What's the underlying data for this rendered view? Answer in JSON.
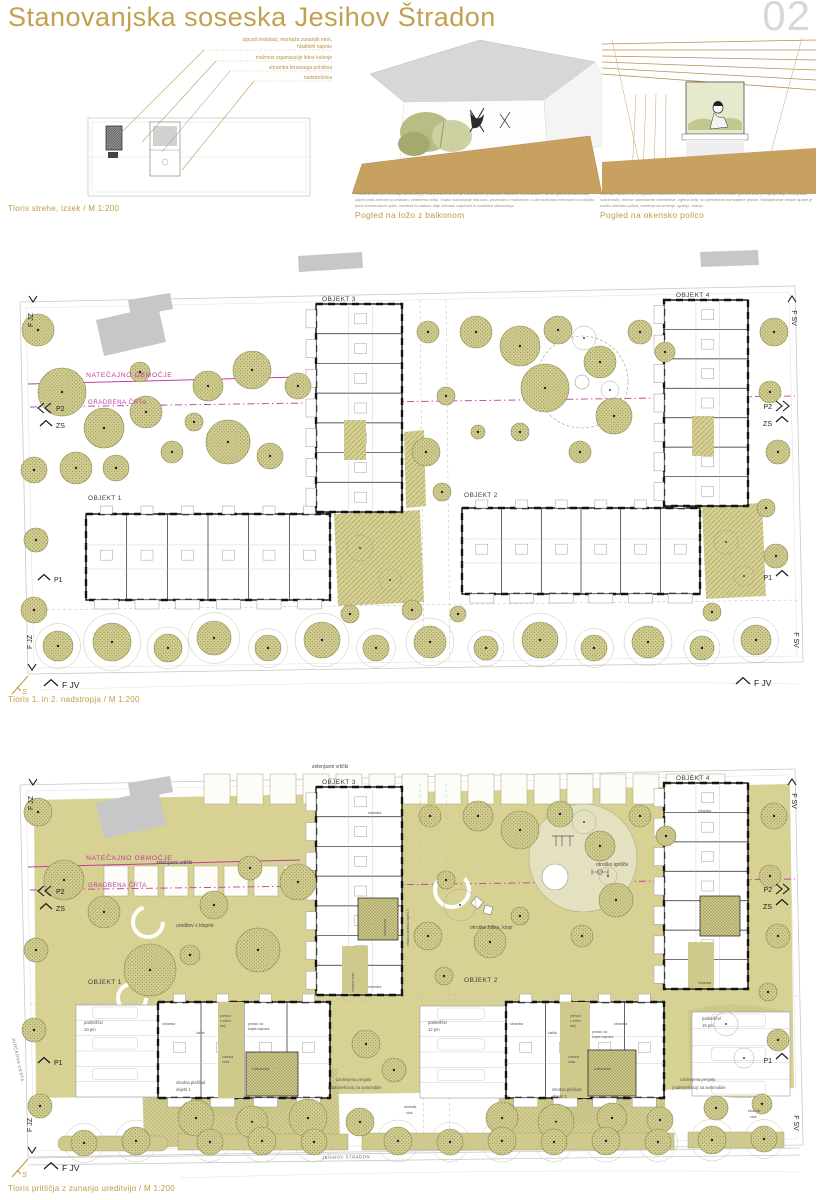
{
  "board": {
    "title": "Stanovanjska soseska Jesihov Štradon",
    "page_number": "02"
  },
  "roof_detail": {
    "caption": "Tloris strehe, izsek / M 1:200",
    "annotations": {
      "a1": "izpusti instalacij, montaža zunanjih enot,",
      "a1b": "hladilnih naprav",
      "a2": "možnost organizacije letne kuhinje",
      "a3": "shramba terasnega pohištva",
      "a4": "nadstrešnica"
    }
  },
  "perspectives": {
    "loggia": {
      "paragraph": "Posebna skrb pri snovanju stanovanj je bila posvečena že pri urbanistični postavitvi objektov s poudarkom, da se glavnina stanovanj odpre proti zelenim površinam, zelenemu atriju. Vsako stanovanje ima ložo, povezano z balkonom. Loža nudi tako intimnost kot zaščito pred vremenskimi vplivi, medtem ko balkon daje občutek odprtosti in razširitve stanovanja.",
      "heading": "Pogled na ložo z balkonom"
    },
    "window": {
      "paragraph": "Okenske špalete so poligonalno zasnovane, kar polici funkcionira kot sedišče (pomembno pri vgrajevanju energetske vzdržnosti), lesene nameščene zatemnitve, zgibna krila, so perforirane kompaktne plošče. Nadaljevanje širokih špalet je svetla okenska polica, namenjena sedenju, igranju, branju.",
      "heading": "Pogled na okensko polico"
    }
  },
  "plan_upper": {
    "caption": "Tloris 1. in 2. nadstropja / M 1:200",
    "labels": {
      "natecajno_obmocje": "NATEČAJNO OBMOČJE",
      "gradbena_crta": "GRADBENA ČRTA",
      "objekt_1": "OBJEKT 1",
      "objekt_2": "OBJEKT 2",
      "objekt_3": "OBJEKT 3",
      "objekt_4": "OBJEKT 4"
    }
  },
  "plan_ground": {
    "caption": "Tloris pritličja z zunanjo ureditvijo / M 1:200",
    "labels": {
      "natecajno_obmocje": "NATEČAJNO OBMOČJE",
      "gradbena_crta": "GRADBENA ČRTA",
      "objekt_1": "OBJEKT 1",
      "objekt_2": "OBJEKT 2",
      "objekt_3": "OBJEKT 3",
      "objekt_4": "OBJEKT 4",
      "zelenjavni_vrticki": "zelenjavni vrtički",
      "ureditev_s_klopmi": "ureditev s klopmi",
      "otrosko_igrisce": "otroško igrišče",
      "otroske_hiske_klopi": "otroške hiške, klopi",
      "parkirisce": "parkirišče/",
      "pm_10": "10 pm",
      "pm_12": "12 pm",
      "pm_15": "15 pm",
      "pergola_1": "ozelenjena pergola",
      "pergola_2": "(nadstrešnica) za avtomobile",
      "ekoloski_1": "ekološki",
      "ekoloski_2": "otok",
      "vhodna_ploscad": "vhodna ploščad",
      "objekt_1_ref": "objekt 1",
      "objekt_2_ref": "objekt 2",
      "vp_objekt_3": "vhodna ploščad objekt 3",
      "prehod_1": "prehod",
      "prehod_2": "v zelen",
      "prehod_3": "atrij",
      "shramba": "shramba",
      "vhodna_veza": "vhodna veža",
      "vhodna_1": "vhodna",
      "veza_2": "veža",
      "kolesarnica": "kolesarnica",
      "cistila": "čistila",
      "prostor_1": "prostor za",
      "prostor_2": "trajne naprave",
      "street_jesihov": "JESIHOV ŠTRADON",
      "street_jurckova": "JURČKOVA CESTA"
    }
  },
  "edge_marks": {
    "f_jz": "F JZ",
    "f_sv": "F SV",
    "f_jv": "F JV",
    "p1": "P1",
    "p2": "P2",
    "zs": "ZS",
    "north": "S"
  },
  "colors": {
    "accent_gold": "#bf9b44",
    "boundary_magenta": "#c23ba0",
    "tree_olive": "#8f8b4f",
    "ground_khaki": "#d7d294",
    "page_number_gray": "#d9d9d9"
  }
}
